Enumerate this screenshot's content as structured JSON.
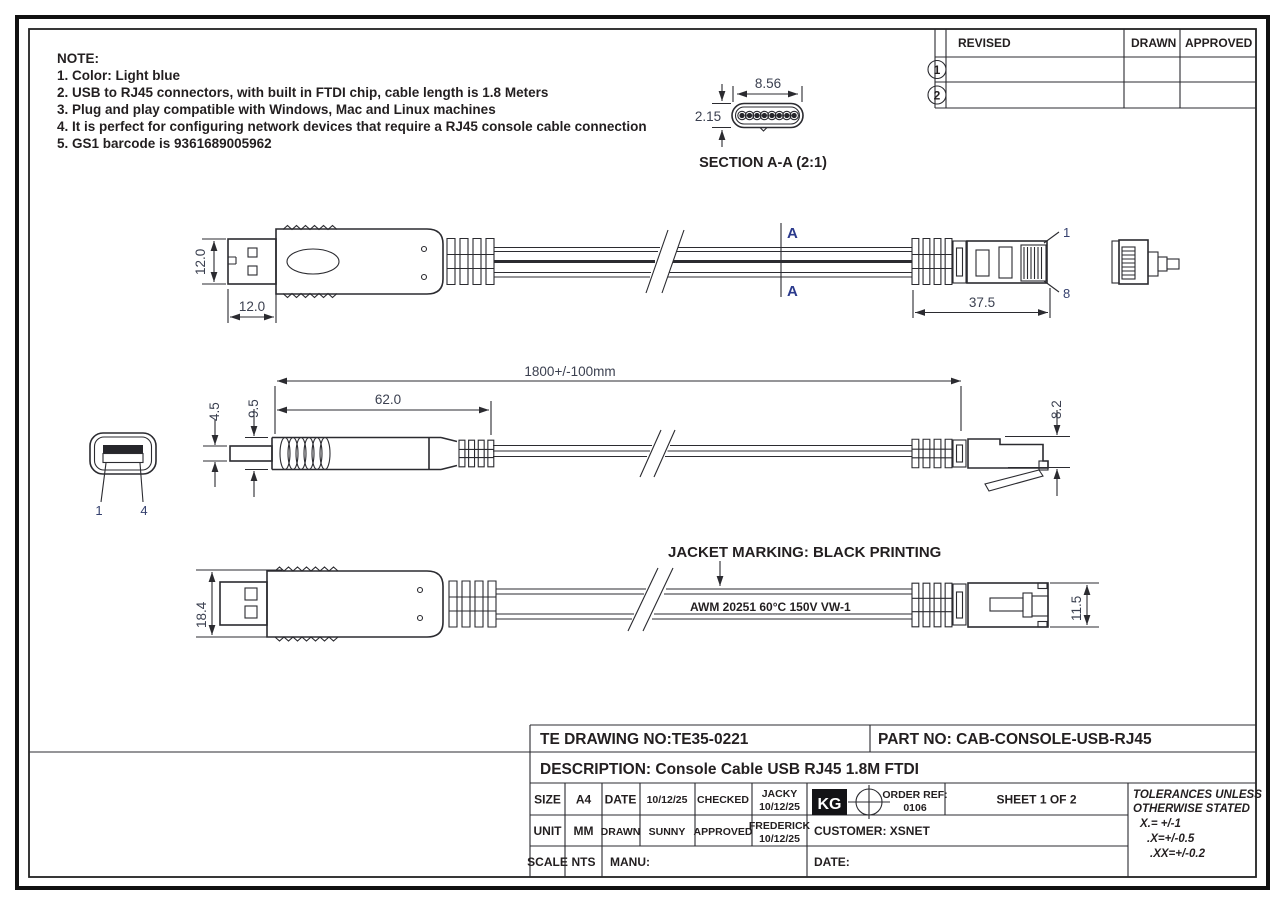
{
  "notes": {
    "title": "NOTE:",
    "items": [
      "1. Color: Light blue",
      "2. USB to RJ45 connectors, with built in FTDI chip, cable length is 1.8 Meters",
      "3. Plug and play compatible with Windows, Mac and Linux machines",
      "4. It is perfect for configuring network devices that require a RJ45 console cable connection",
      "5. GS1 barcode is 9361689005962"
    ]
  },
  "revision_table": {
    "revised_header": "REVISED",
    "drawn_header": "DRAWN",
    "approved_header": "APPROVED",
    "row1_no": "1",
    "row2_no": "2"
  },
  "section_view": {
    "label": "SECTION A-A (2:1)",
    "dim_width": "8.56",
    "dim_height": "2.15"
  },
  "view_top": {
    "dim_connector_height": "12.0",
    "dim_shell_width": "12.0",
    "dim_rj45_length": "37.5",
    "section_marker": "A",
    "pin_first": "1",
    "pin_last": "8"
  },
  "view_middle": {
    "dim_overall_length": "1800+/-100mm",
    "dim_body_length": "62.0",
    "dim_shell_height": "4.5",
    "dim_body_height": "9.5",
    "dim_rj45_height": "8.2",
    "usb_pin_first": "1",
    "usb_pin_last": "4"
  },
  "view_bottom": {
    "dim_overmold_height": "18.4",
    "dim_rj45_width": "11.5",
    "marking_callout": "JACKET MARKING: BLACK PRINTING",
    "marking_text": "AWM 20251 60°C 150V VW-1"
  },
  "title_block": {
    "drawing_no": "TE DRAWING NO:TE35-0221",
    "part_no": "PART NO: CAB-CONSOLE-USB-RJ45",
    "description": "DESCRIPTION: Console Cable USB RJ45 1.8M FTDI",
    "size_label": "SIZE",
    "size_value": "A4",
    "date_label": "DATE",
    "date_value": "10/12/25",
    "checked_label": "CHECKED",
    "checked_by": "JACKY",
    "checked_date": "10/12/25",
    "unit_label": "UNIT",
    "unit_value": "MM",
    "drawn_label": "DRAWN",
    "drawn_by": "SUNNY",
    "approved_label": "APPROVED",
    "approved_by": "FREDERICK",
    "approved_date": "10/12/25",
    "scale_label": "SCALE",
    "scale_value": "NTS",
    "manu_label": "MANU:",
    "logo_text": "KG",
    "order_ref_label": "ORDER REF:",
    "order_ref_value": "0106",
    "sheet": "SHEET 1 OF 2",
    "customer": "CUSTOMER: XSNET",
    "date_field_label": "DATE:",
    "tolerances": {
      "line1": "TOLERANCES UNLESS",
      "line2": "OTHERWISE STATED",
      "line3": "X.= +/-1",
      "line4": ".X=+/-0.5",
      "line5": ".XX=+/-0.2"
    }
  },
  "colors": {
    "line": "#2b2b30",
    "text": "#231f20",
    "section_marker": "#2b3a8c",
    "background": "#ffffff"
  }
}
